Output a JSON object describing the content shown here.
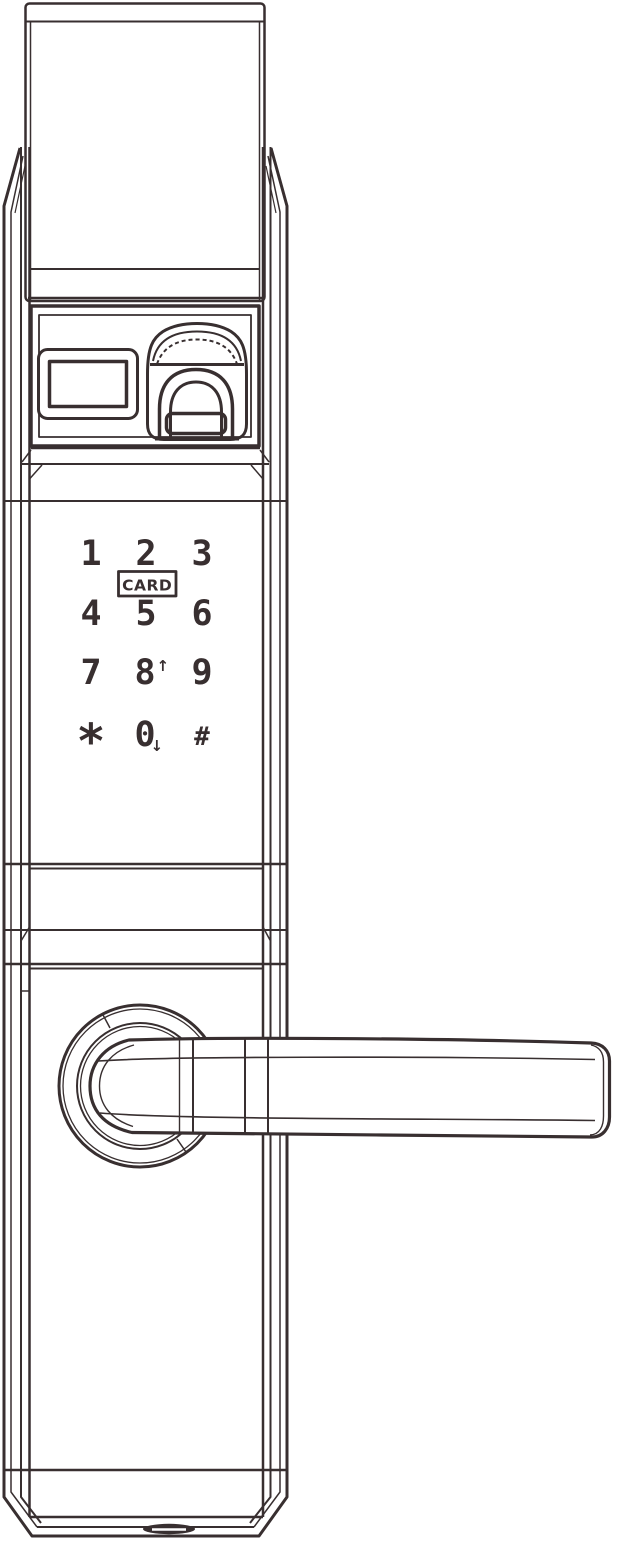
{
  "colors": {
    "line": "#382f30",
    "background": "#ffffff"
  },
  "card_reader": {
    "label": "CARD"
  },
  "keypad": {
    "keys": [
      {
        "label": "1"
      },
      {
        "label": "2"
      },
      {
        "label": "3"
      },
      {
        "label": "4"
      },
      {
        "label": "5"
      },
      {
        "label": "6"
      },
      {
        "label": "7"
      },
      {
        "label": "8",
        "arrow": "↑"
      },
      {
        "label": "9"
      },
      {
        "label": "*"
      },
      {
        "label": "0",
        "arrow": "↓"
      },
      {
        "label": "#"
      }
    ]
  }
}
